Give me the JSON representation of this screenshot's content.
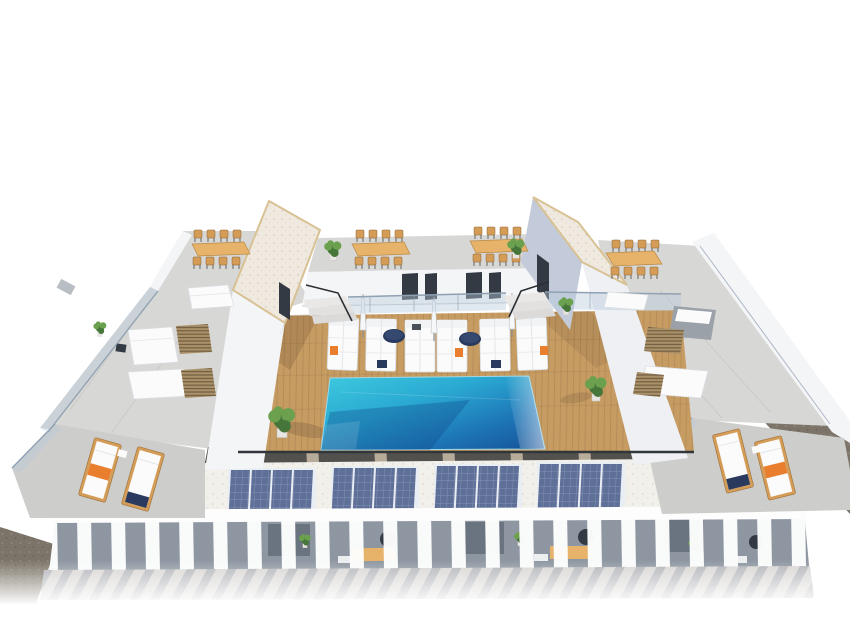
{
  "meta": {
    "type": "3d-architectural-render",
    "subject": "Aerial rendering of a residential rooftop: communal wooden pool deck with rectangular pool, white sunbeds and closed umbrellas, two stair towers with gravel roofs, wooden dining sets, concrete side terraces with white sofas and vent grates, four solar panel arrays over a white pergola colonnade, corner lounger terraces with orange towels, dark gravel perimeter strips",
    "view": "high-angle three-quarter"
  },
  "palette": {
    "page_bg": "#ffffff",
    "wall": "#f4f5f7",
    "wall_shade": "#c3cbda",
    "wall_face": "#eef0f4",
    "concrete": "#d7d7d5",
    "concrete_2": "#cdcdcb",
    "roof_gravel": "#efe9df",
    "roof_trim": "#d8c193",
    "deck": "#c79c63",
    "deck_line": "#a87f4e",
    "pool_turquoise": "#3ecadf",
    "pool_mid": "#2aa9d2",
    "pool_deep": "#1d74b6",
    "pool_dark": "#155096",
    "glass": "#b8cbdc",
    "rail": "#8fa1b2",
    "white_furn": "#fbfbfb",
    "navy": "#2a3a5e",
    "orange": "#e97e2e",
    "wood_table": "#e7b269",
    "wood_chair": "#d49c56",
    "solar": "#5f7098",
    "solar_frame": "#e9edf4",
    "gravel_dark": "#7c7468",
    "stone": "#b7ab9a",
    "grate": "#ab9168",
    "grate_line": "#6e5c42",
    "colonnade": "#8d96a1",
    "lower_concrete": "#d8d6d3",
    "shadow_band": "#53514e",
    "dark_fixture": "#343a44",
    "fin": "#fdfdfd",
    "plant_dark": "#47763a",
    "plant_light": "#6ba14e"
  },
  "scene": {
    "stair_towers": 2,
    "pool": {
      "count": 1,
      "shape": "rectangular",
      "water_colors": [
        "turquoise",
        "deep-blue"
      ]
    },
    "deck_material": "wood-planks",
    "poolside_sunbeds": {
      "count": 6,
      "color": "white"
    },
    "round_daybeds": {
      "count": 2,
      "color": "navy"
    },
    "closed_umbrellas": 3,
    "dining_sets": {
      "count": 4,
      "material": "wood"
    },
    "solar_arrays": {
      "groups": 4,
      "modules_per_group": 4
    },
    "corner_loungers": {
      "count": 4,
      "accent": "orange-towel"
    },
    "vent_grates": 4,
    "white_sofas": 5,
    "potted_plants": 9,
    "pergola": "white-fin colonnade over private terraces",
    "balustrades": "glass",
    "perimeter": "dark gravel strips"
  }
}
